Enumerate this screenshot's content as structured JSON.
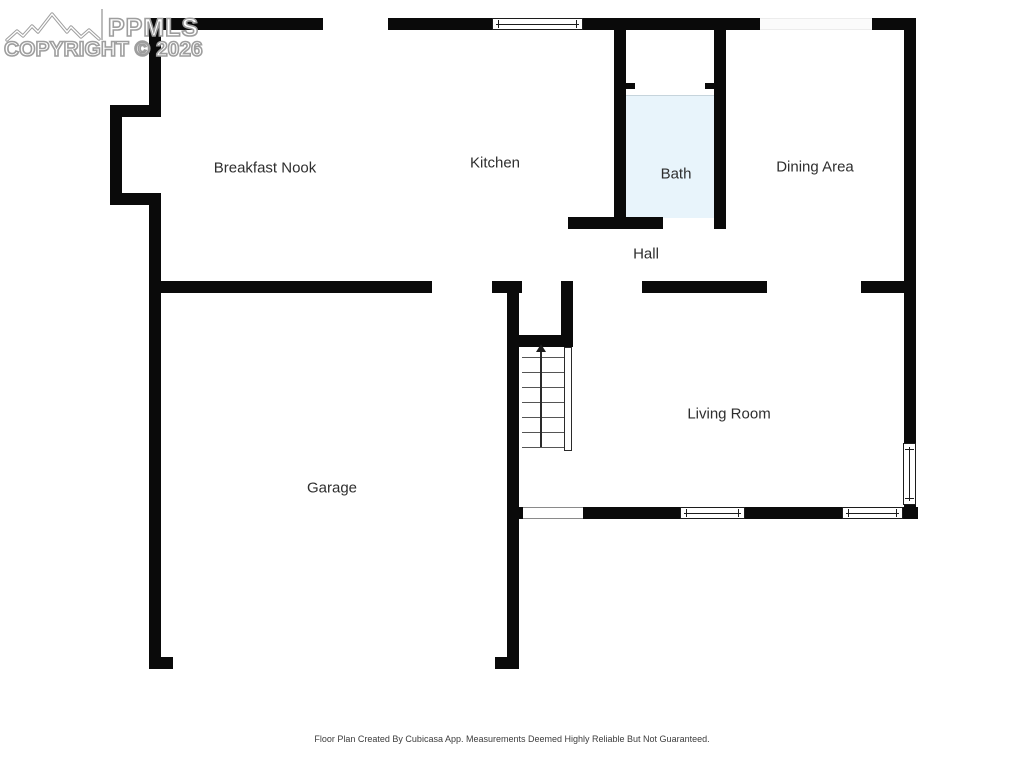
{
  "watermark": {
    "brand": "PPMLS",
    "copyright": "COPYRIGHT © 2026",
    "logo_icon": "mountain-range-icon"
  },
  "rooms": {
    "breakfast_nook": "Breakfast Nook",
    "kitchen": "Kitchen",
    "bath": "Bath",
    "dining_area": "Dining Area",
    "hall": "Hall",
    "living_room": "Living Room",
    "garage": "Garage"
  },
  "stairs": {
    "direction_icon": "up-arrow-icon"
  },
  "footer": {
    "disclaimer": "Floor Plan Created By Cubicasa App. Measurements Deemed Highly Reliable But Not Guaranteed."
  },
  "colors": {
    "wall": "#0a0a0a",
    "bath_floor": "#e8f4fb",
    "watermark_gray": "#9e9e9e"
  }
}
